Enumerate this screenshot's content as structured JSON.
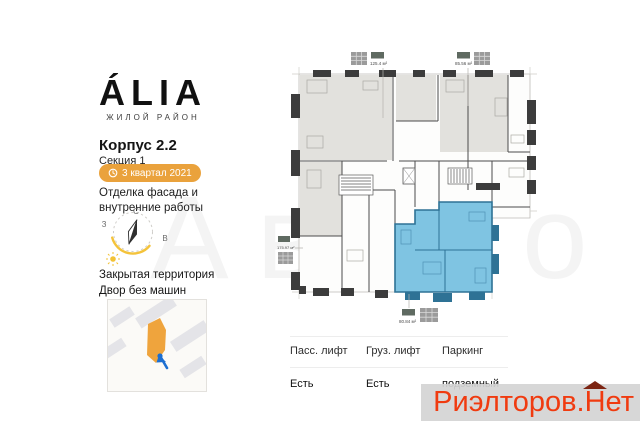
{
  "brand": {
    "logo": "ÁLIA",
    "tagline": "ЖИЛОЙ РАЙОН"
  },
  "building": {
    "title": "Корпус 2.2",
    "section": "Секция 1",
    "completion": "3 квартал 2021",
    "status_line1": "Отделка фасада и",
    "status_line2": "внутренние работы",
    "badge_color": "#eaa23c"
  },
  "compass": {
    "north": "С",
    "west": "З",
    "east": "В"
  },
  "features": [
    "Закрытая территория",
    "Двор без машин"
  ],
  "floorplan": {
    "areas": {
      "apartment_top_left": "125.4 м²",
      "apartment_top_right": "85.56 м²",
      "apartment_left": "175.97 м²",
      "apartment_selected": "80.84 м²"
    },
    "selected_fill": "#7fc4e2",
    "selected_wall": "#2e7295",
    "wall_color": "#3c3c3c",
    "room_fill": "#e2e1dd"
  },
  "amenities": {
    "columns": [
      {
        "header": "Пасс. лифт",
        "value": "Есть"
      },
      {
        "header": "Груз. лифт",
        "value": "Есть"
      },
      {
        "header": "Паркинг",
        "value": "подземный"
      }
    ]
  },
  "watermark": {
    "prefix": "Риэлторов.",
    "house_letter": "Н",
    "suffix": "ет",
    "text_color": "#f03b10",
    "roof_color": "#7c2412"
  },
  "background_watermark": "Авито"
}
